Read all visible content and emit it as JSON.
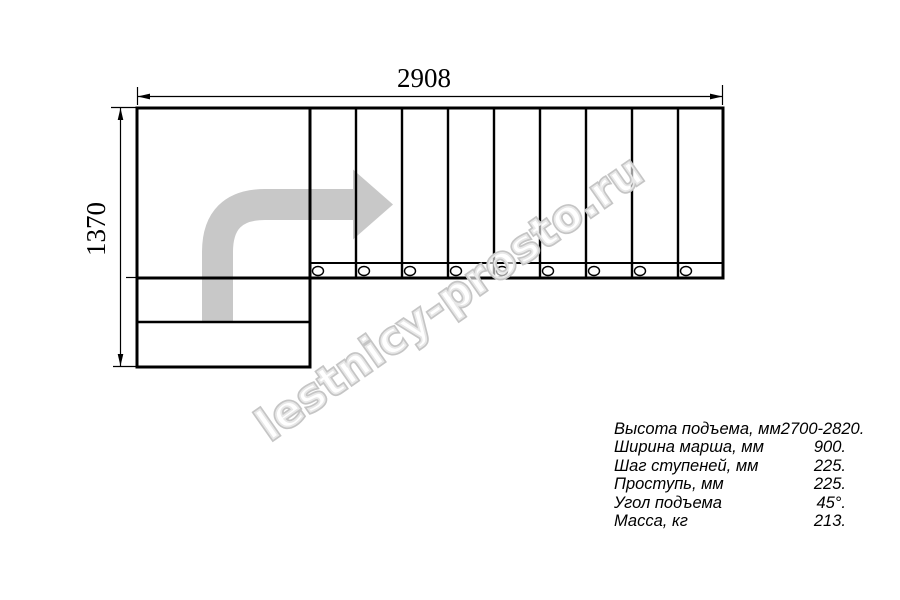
{
  "drawing": {
    "width_label": "2908",
    "height_label": "1370",
    "tread_count": 9,
    "baluster_count": 9,
    "lower_step_count": 2
  },
  "specs": {
    "rows": [
      {
        "label": "Высота подъема, мм",
        "value": "2700-2820."
      },
      {
        "label": "Ширина марша, мм",
        "value": "900."
      },
      {
        "label": "Шаг ступеней, мм",
        "value": "225."
      },
      {
        "label": "Проступь, мм",
        "value": "225."
      },
      {
        "label": "Угол подъема",
        "value": "45°."
      },
      {
        "label": "Масса, кг",
        "value": "213."
      }
    ]
  },
  "watermark": {
    "text": "lestnicy-prosto.ru",
    "outline_color": "#c5c5c5"
  },
  "colors": {
    "line": "#000000",
    "arrow": "#c8c8c8",
    "background": "#ffffff"
  }
}
